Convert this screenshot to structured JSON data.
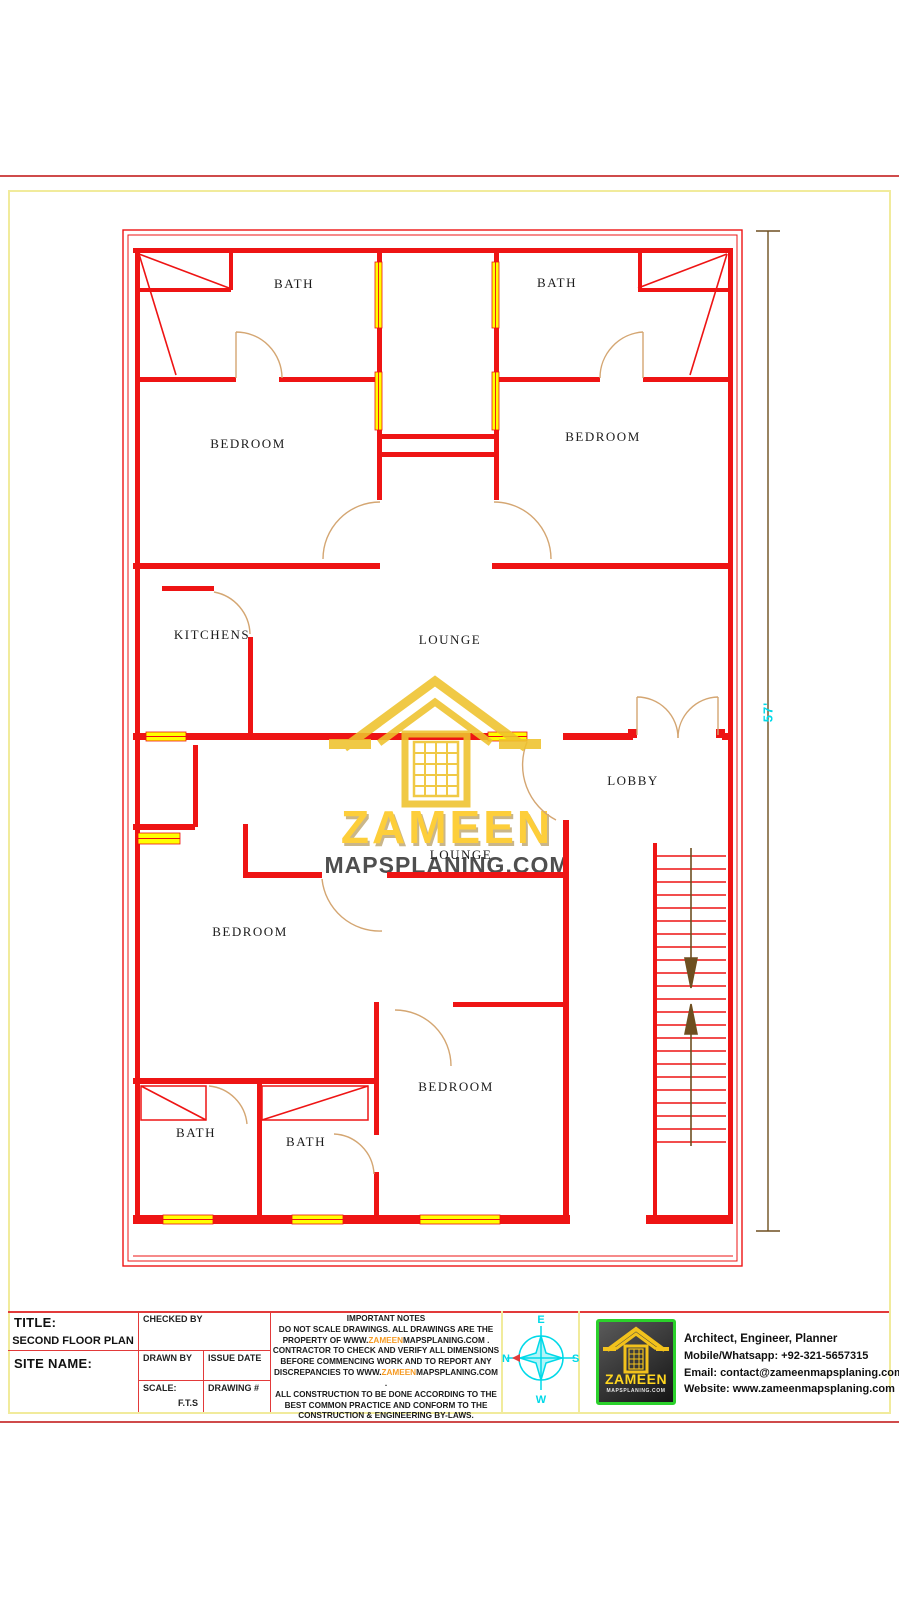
{
  "plan": {
    "rooms": [
      {
        "label": "BATH",
        "x": 294,
        "y": 284
      },
      {
        "label": "BATH",
        "x": 557,
        "y": 283
      },
      {
        "label": "BEDROOM",
        "x": 248,
        "y": 444
      },
      {
        "label": "BEDROOM",
        "x": 603,
        "y": 437
      },
      {
        "label": "KITCHENS",
        "x": 212,
        "y": 635
      },
      {
        "label": "LOUNGE",
        "x": 450,
        "y": 640
      },
      {
        "label": "LOBBY",
        "x": 633,
        "y": 781
      },
      {
        "label": "LOUNGE",
        "x": 461,
        "y": 855
      },
      {
        "label": "BEDROOM",
        "x": 250,
        "y": 932
      },
      {
        "label": "BEDROOM",
        "x": 456,
        "y": 1087
      },
      {
        "label": "BATH",
        "x": 196,
        "y": 1133
      },
      {
        "label": "BATH",
        "x": 306,
        "y": 1142
      }
    ],
    "dimension": "57'",
    "watermark": {
      "brand": "ZAMEEN",
      "domain": "MAPSPLANING.COM"
    }
  },
  "title_block": {
    "title_label": "TITLE:",
    "title_value": "SECOND FLOOR PLAN",
    "site_label": "SITE NAME:",
    "checked_by": "CHECKED BY",
    "drawn_by": "DRAWN BY",
    "issue_date": "ISSUE DATE",
    "scale_label": "SCALE:",
    "scale_value": "F.T.S",
    "drawing_no": "DRAWING #"
  },
  "notes": {
    "title": "IMPORTANT NOTES",
    "l1": "DO NOT SCALE DRAWINGS. ALL DRAWINGS ARE THE",
    "l2_pre": "PROPERTY OF  WWW.",
    "l2_hl": "ZAMEEN",
    "l2_post": "MAPSPLANING.COM .",
    "l3": "CONTRACTOR TO CHECK AND VERIFY ALL DIMENSIONS",
    "l4": "BEFORE COMMENCING WORK AND TO REPORT ANY",
    "l5_pre": "DISCREPANCIES TO WWW.",
    "l5_hl": "ZAMEEN",
    "l5_post": "MAPSPLANING.COM .",
    "l6": "ALL CONSTRUCTION TO BE DONE ACCORDING TO THE",
    "l7": "BEST COMMON PRACTICE AND CONFORM TO THE",
    "l8": "CONSTRUCTION & ENGINEERING BY-LAWS."
  },
  "compass": {
    "n": "N",
    "e": "E",
    "s": "S",
    "w": "W"
  },
  "logo": {
    "brand": "ZAMEEN",
    "domain": "MAPSPLANING.COM"
  },
  "contact": {
    "role": "Architect, Engineer, Planner",
    "mobile": "Mobile/Whatsapp: +92-321-5657315",
    "email": "Email: contact@zameenmapsplaning.com",
    "website": "Website: www.zameenmapsplaning.com"
  },
  "colors": {
    "wall_red": "#ee1414",
    "window_yellow": "#ffff00",
    "door_tan": "#d4a672",
    "dimension_brown": "#6e4f20",
    "accent_cyan": "#00d9e8",
    "watermark_gold": "#efc22c",
    "highlight_orange": "#f59a23",
    "logo_green": "#2bd12b"
  }
}
